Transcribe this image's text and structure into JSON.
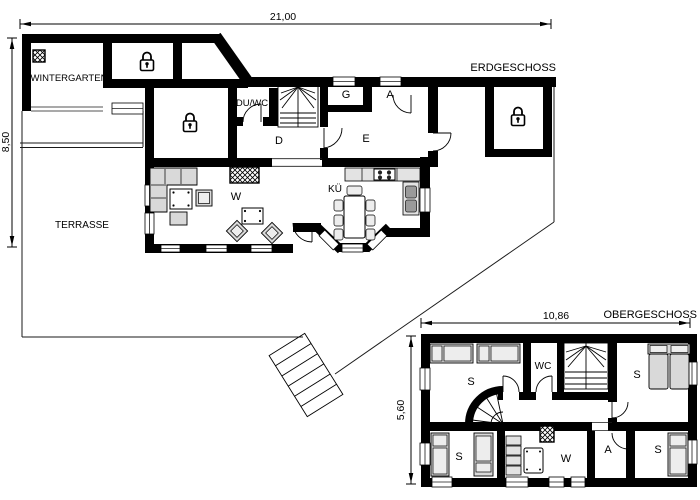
{
  "ground_floor": {
    "title": "ERDGESCHOSS",
    "width_dim": "21,00",
    "height_dim": "8,50",
    "rooms": {
      "wintergarten": "WINTERGARTEN",
      "terrace": "TERRASSE",
      "shower_wc": "DU/WC",
      "hall": "D",
      "closet": "G",
      "storage": "A",
      "e_room": "E",
      "living": "W",
      "kitchen": "KÜ"
    }
  },
  "upper_floor": {
    "title": "OBERGESCHOSS",
    "width_dim": "10,86",
    "height_dim": "5,60",
    "rooms": {
      "bedroom_nw": "S",
      "wc": "WC",
      "bedroom_ne": "S",
      "bedroom_sw": "S",
      "lounge": "W",
      "storage": "A",
      "bedroom_se": "S"
    }
  },
  "colors": {
    "wall": "#000000",
    "furniture": "#d9d9d9",
    "furniture_light": "#ededed",
    "counter": "#e3e3e3",
    "background": "#ffffff"
  }
}
